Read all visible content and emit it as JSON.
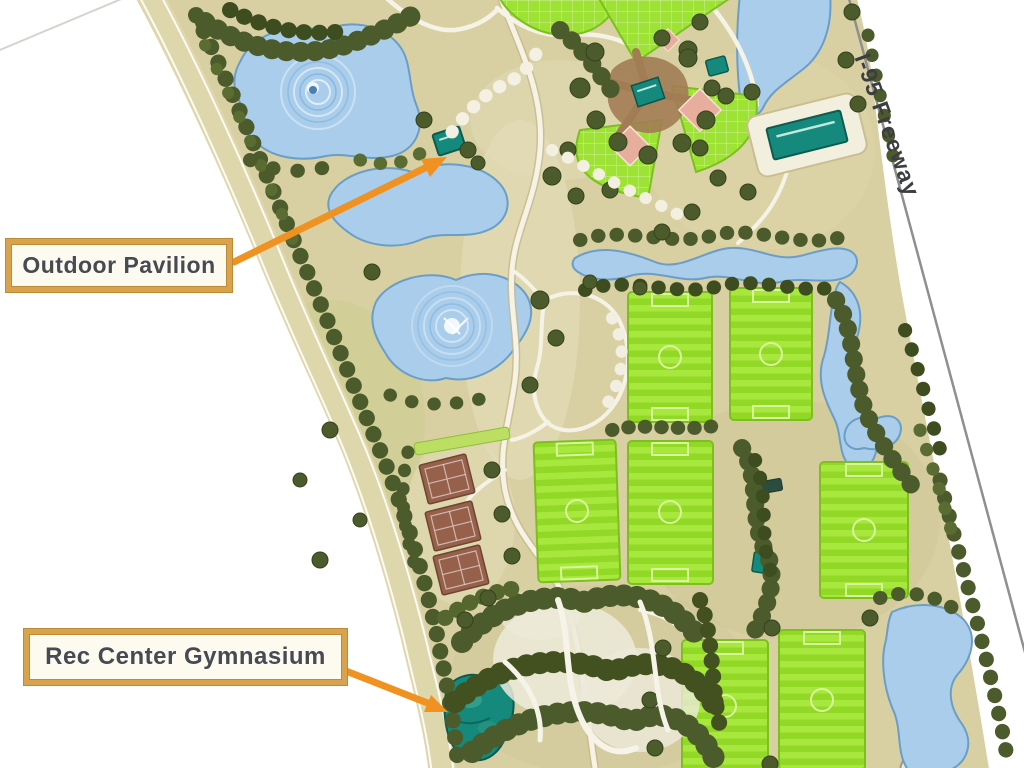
{
  "map": {
    "callouts": [
      {
        "label": "Outdoor Pavilion"
      },
      {
        "label": "Rec Center Gymnasium"
      }
    ],
    "road_label": "I-95 Freeway",
    "features": {
      "lakes": 6,
      "soccer_fields": 7,
      "baseball_fields": 4,
      "tennis_court_pads": 3,
      "buildings": [
        "outdoor-pavilion",
        "rec-center-gymnasium",
        "baseball-hub",
        "parking-building"
      ]
    },
    "colors": {
      "ground": "#d8d0a2",
      "water": "#a9cdea",
      "water_edge": "#6b9ec7",
      "field_green": "#9ddb31",
      "tree_green": "#4c5b2b",
      "building_teal": "#15897b",
      "tennis_clay": "#96604a",
      "infield_pink": "#e7ae9e",
      "arrow_orange": "#ef9221",
      "callout_border": "#d9a24c",
      "callout_bg": "#fdfaf0",
      "callout_text": "#464b53",
      "road_gray": "#8f8f8c"
    }
  }
}
